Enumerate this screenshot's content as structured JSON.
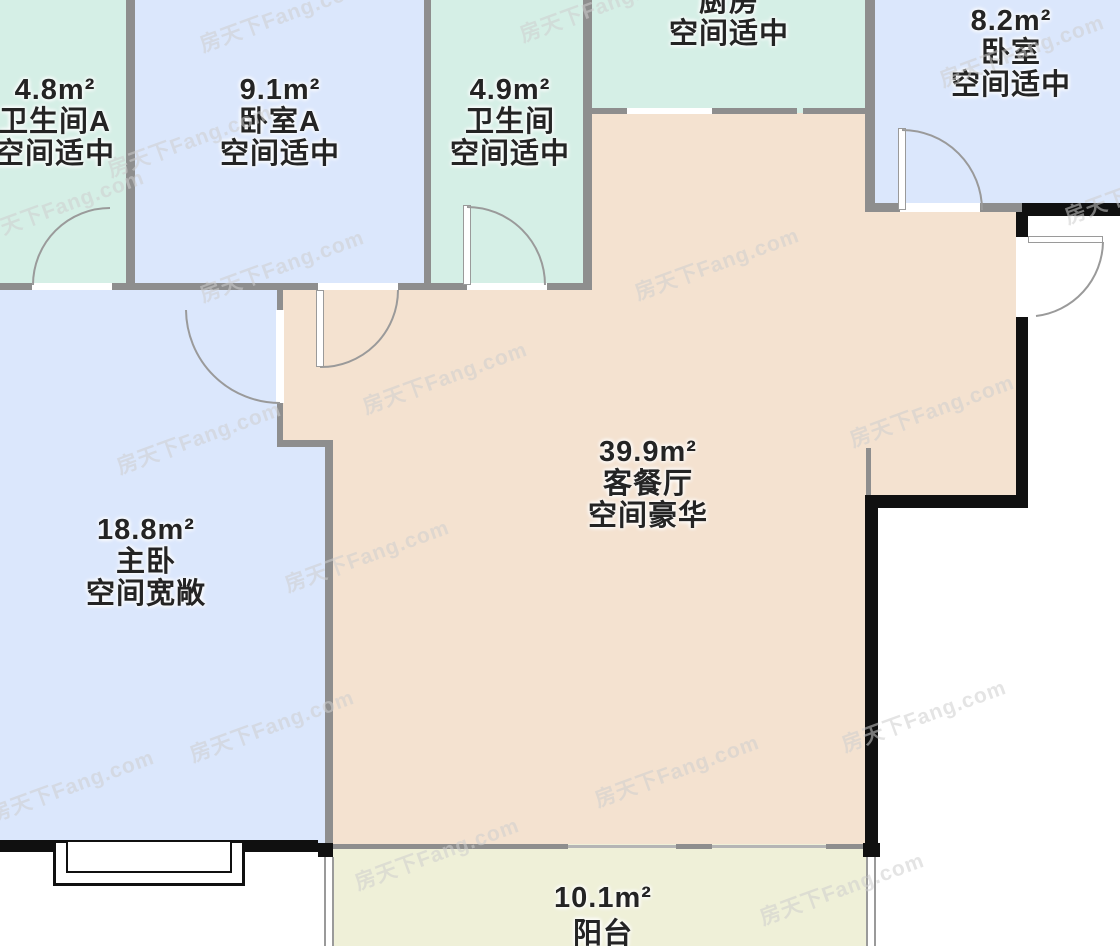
{
  "watermark": {
    "text": "房天下Fang.com"
  },
  "colors": {
    "bathroom_fill": "#d5efe6",
    "bedroom_fill": "#dbe7fc",
    "living_fill": "#f4e2d0",
    "balcony_fill": "#eff0d8",
    "interior_wall": "#8e8e8e",
    "exterior_wall": "#101010",
    "label_text": "#242424"
  },
  "rooms": {
    "bathroom_a": {
      "area": "4.8m²",
      "name": "卫生间A",
      "quality": "空间适中"
    },
    "bedroom_a": {
      "area": "9.1m²",
      "name": "卧室A",
      "quality": "空间适中"
    },
    "bathroom": {
      "area": "4.9m²",
      "name": "卫生间",
      "quality": "空间适中"
    },
    "kitchen": {
      "name": "厨房",
      "quality": "空间适中"
    },
    "bedroom": {
      "area": "8.2m²",
      "name": "卧室",
      "quality": "空间适中"
    },
    "master_bedroom": {
      "area": "18.8m²",
      "name": "主卧",
      "quality": "空间宽敞"
    },
    "living_dining": {
      "area": "39.9m²",
      "name": "客餐厅",
      "quality": "空间豪华"
    },
    "balcony": {
      "area": "10.1m²",
      "name": "阳台"
    }
  }
}
